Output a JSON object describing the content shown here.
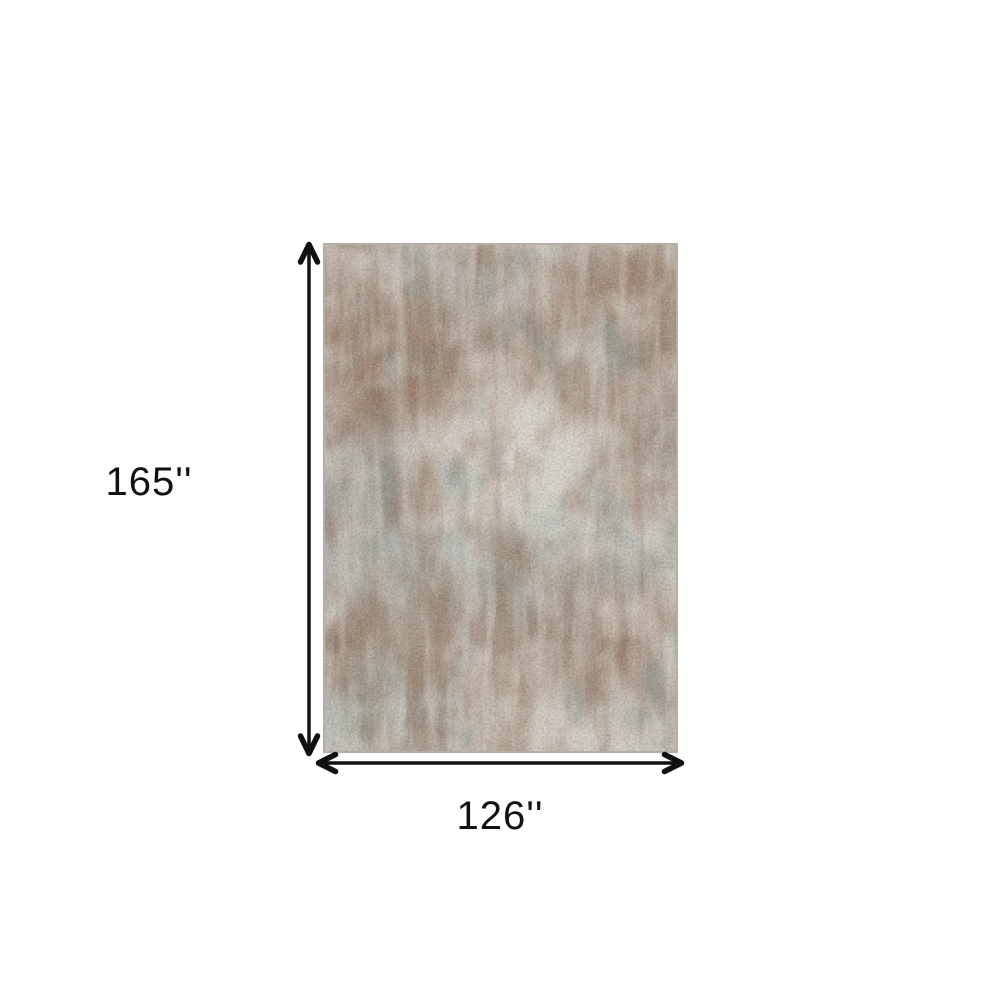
{
  "diagram": {
    "height_label": "165''",
    "width_label": "126''",
    "colors": {
      "background": "#ffffff",
      "arrow": "#111111",
      "label_text": "#111111",
      "rug_base": "#cac6bf",
      "rug_border": "#b2afaa",
      "rug_brown": "#8a6a52",
      "rug_dark_brown": "#6e6158",
      "rug_slate_teal": "#859b98",
      "rug_sage": "#9fb0ab",
      "rug_cream": "#dcd8d0",
      "rug_dark_gray": "#6f6660"
    }
  }
}
